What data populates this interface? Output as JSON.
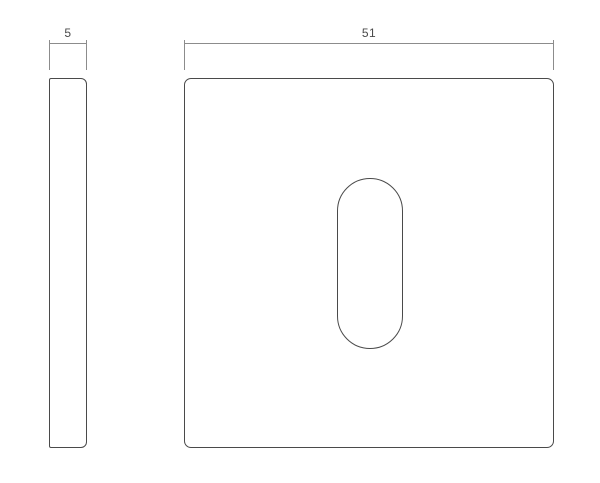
{
  "drawing": {
    "type": "technical-dimension-drawing",
    "views": {
      "side": {
        "name": "side-view-plate",
        "dimension_label": "5"
      },
      "front": {
        "name": "front-view-plate",
        "dimension_label": "51",
        "cutout": "stadium-keyhole-slot"
      }
    },
    "colors": {
      "background": "#ffffff",
      "part_outline": "#4a4a4a",
      "dimension_line": "#8c8c8c",
      "dimension_text": "#4a4a4a"
    }
  }
}
